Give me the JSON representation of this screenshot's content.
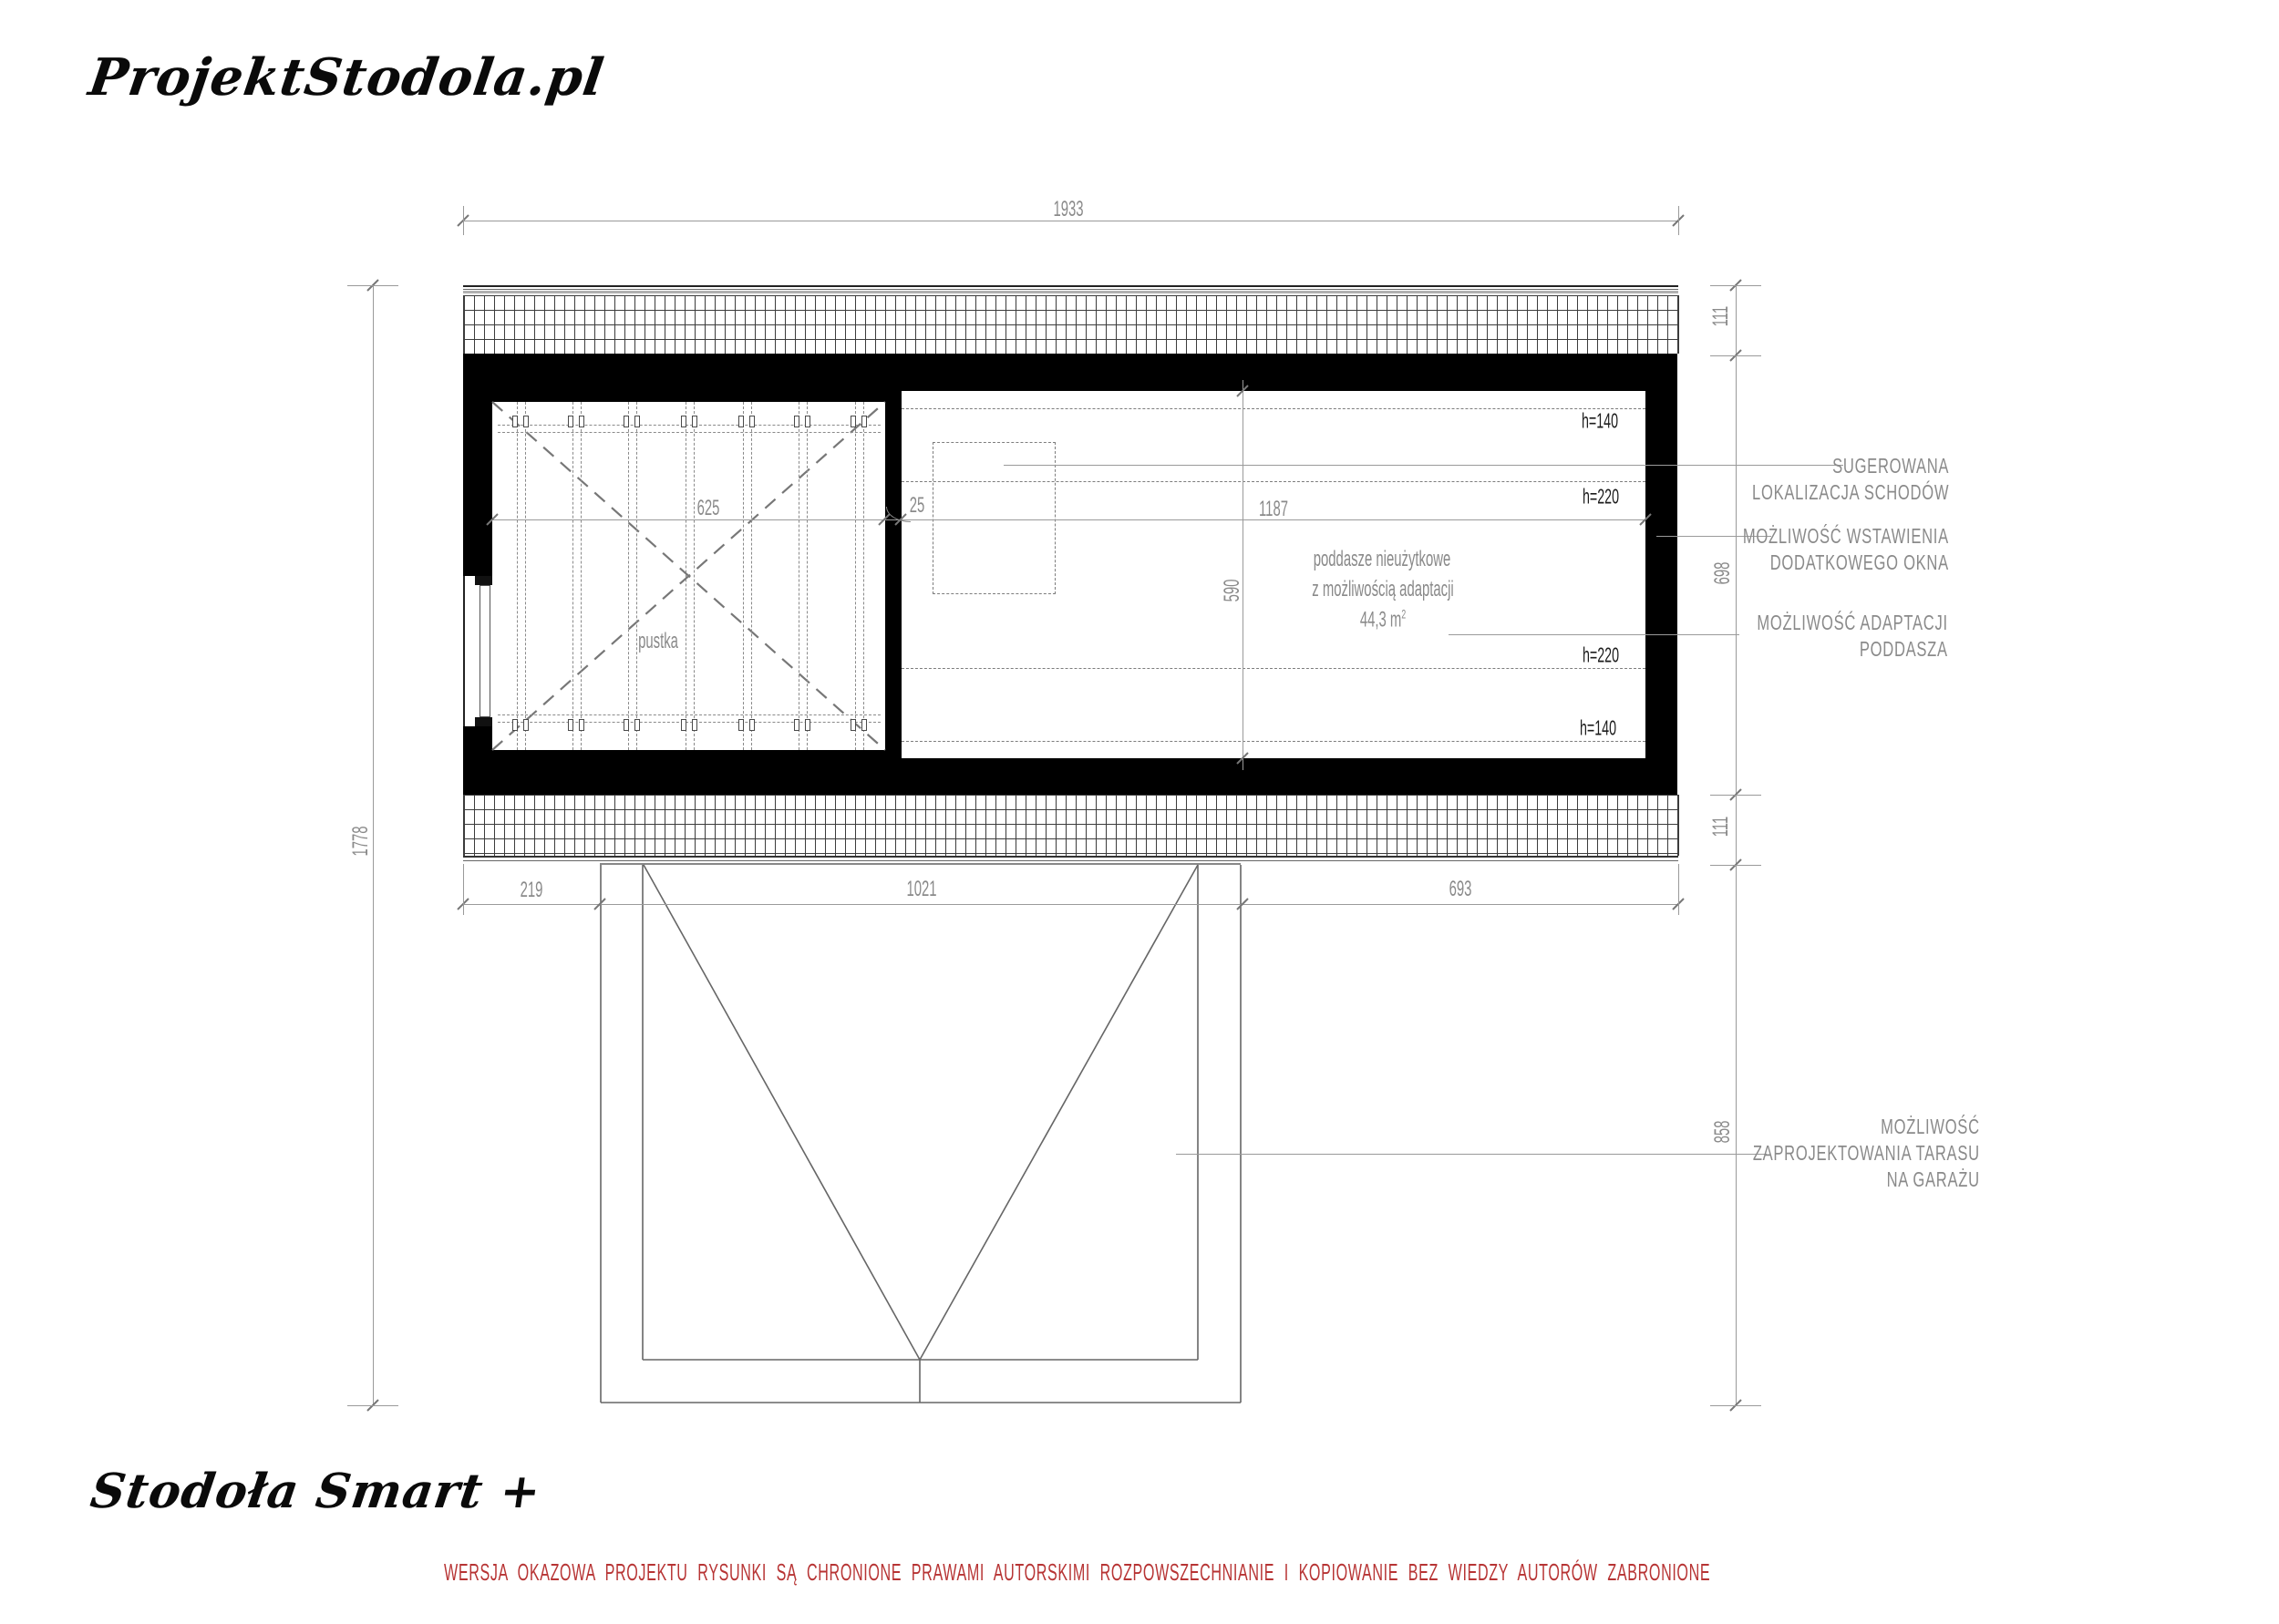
{
  "branding": {
    "logo_top": "ProjektStodola.pl",
    "logo_bottom": "Stodoła Smart +"
  },
  "footer": {
    "copyright": "WERSJA OKAZOWA PROJEKTU RYSUNKI SĄ CHRONIONE PRAWAMI AUTORSKIMI ROZPOWSZECHNIANIE I KOPIOWANIE BEZ WIEDZY AUTORÓW ZABRONIONE"
  },
  "colors": {
    "wall": "#000000",
    "dimension_text": "#8a8a8a",
    "warning_text": "#b73434",
    "line": "#9a9a9a"
  },
  "rooms": {
    "pustka_label": "pustka",
    "attic_line1": "poddasze nieużytkowe",
    "attic_line2": "z możliwością adaptacji",
    "attic_area": "44,3 m",
    "attic_area_sup": "2"
  },
  "height_labels": {
    "top_h140": "h=140",
    "top_h220": "h=220",
    "bottom_h220": "h=220",
    "bottom_h140": "h=140"
  },
  "dimensions": {
    "overall_width": "1933",
    "overall_height": "1778",
    "pustka_width": "625",
    "interior_wall": "25",
    "attic_width": "1187",
    "attic_depth": "590",
    "right_roof_top": "111",
    "right_wall_span": "698",
    "right_roof_bottom": "111",
    "right_garage": "858",
    "bottom_left": "219",
    "bottom_garage": "1021",
    "bottom_right": "693"
  },
  "annotations": {
    "stairs_1": "SUGEROWANA",
    "stairs_2": "LOKALIZACJA SCHODÓW",
    "window_1": "MOŻLIWOŚĆ WSTAWIENIA",
    "window_2": "DODATKOWEGO OKNA",
    "adapt_1": "MOŻLIWOŚĆ ADAPTACJI",
    "adapt_2": "PODDASZA",
    "terrace_1": "MOŻLIWOŚĆ",
    "terrace_2": "ZAPROJEKTOWANIA TARASU",
    "terrace_3": "NA GARAŻU"
  }
}
